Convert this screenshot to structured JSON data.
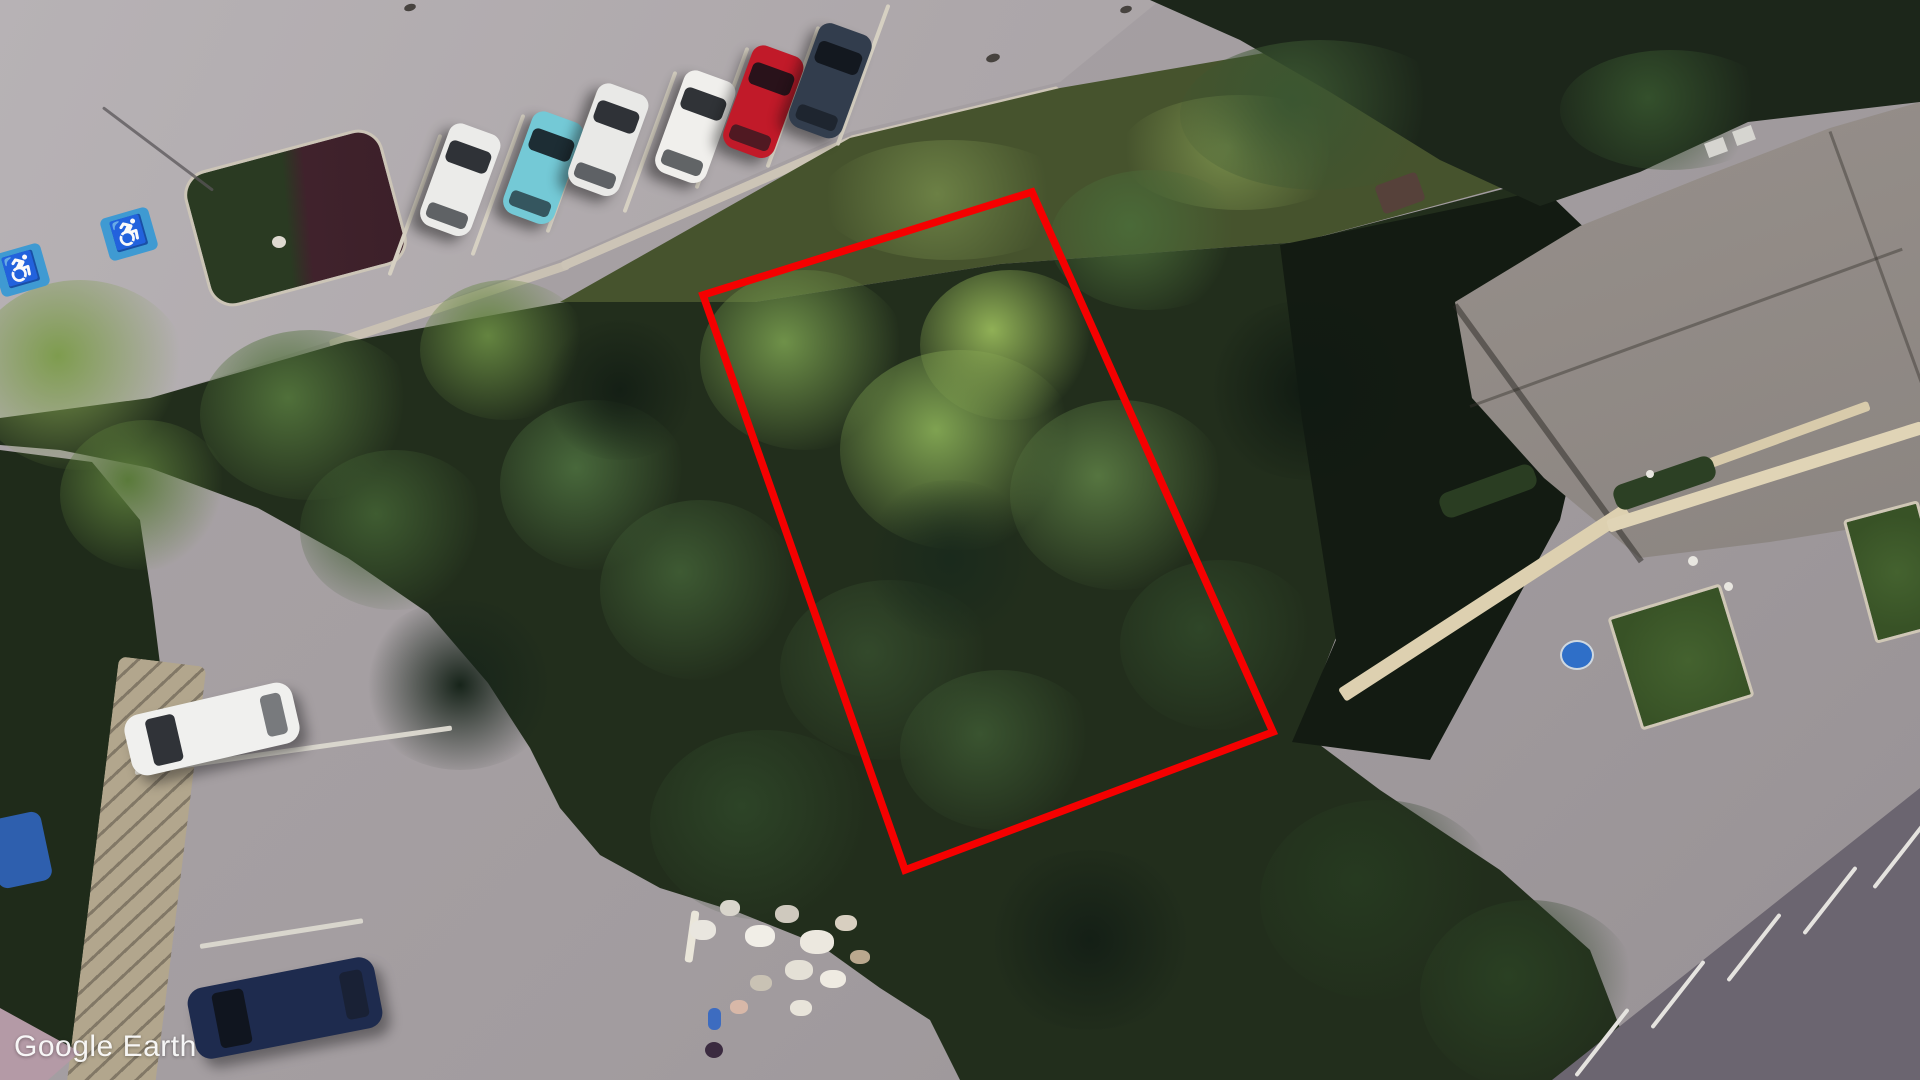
{
  "app": {
    "watermark": "Google Earth"
  },
  "annotation": {
    "label": "highlighted-parcel-boundary",
    "points": "703,295 1032,192 1273,732 905,870",
    "color": "#f50000",
    "stroke_width": 7.5
  },
  "scene": {
    "description": "Aerial view of a tree-covered vacant parcel outlined in red, between a parking lot with parked cars (top), townhouse roofs (right) and a smaller parking area (bottom left)",
    "markings": {
      "accessible_icon": "♿"
    },
    "cars_top_row": [
      {
        "name": "white-car",
        "color": "#ebebe9"
      },
      {
        "name": "teal-car",
        "color": "#74c9d6"
      },
      {
        "name": "silver-car",
        "color": "#e9e9e7"
      },
      {
        "name": "white-car-sunroof",
        "color": "#f0efec"
      },
      {
        "name": "red-car",
        "color": "#c11a29"
      },
      {
        "name": "dark-blue-car",
        "color": "#323d4d"
      }
    ],
    "cars_bottom": [
      {
        "name": "white-suv",
        "color": "#f0f0ee"
      },
      {
        "name": "navy-car",
        "color": "#1e2b4e"
      }
    ],
    "colors": {
      "road": "#aca6a9",
      "trees": "#24311e",
      "roof": "#9b9590",
      "grass": "#47552e",
      "accessible_blue": "#3f9ad2",
      "pool_blue": "#2f6fc8",
      "island_shrubs_maroon": "#3c2029"
    }
  }
}
